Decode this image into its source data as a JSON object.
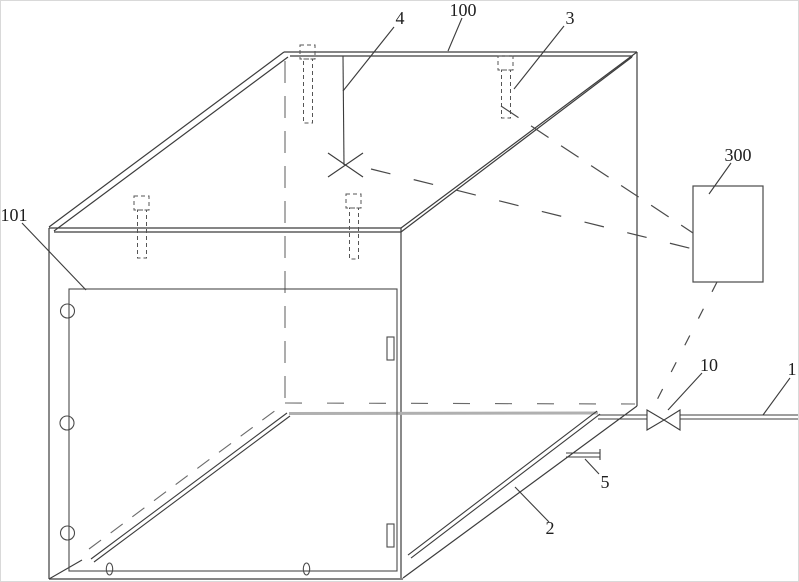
{
  "figure": {
    "kind": "patent-technical-line-drawing",
    "colors": {
      "line": "#3c3c3c",
      "hidden_dash": "#6a6a6a",
      "signal_dash": "#4a4a4a",
      "floor_back_edge": "#b0b0b0",
      "background": "#ffffff"
    }
  },
  "ref_labels": {
    "l100": "100",
    "l101": "101",
    "l3": "3",
    "l4": "4",
    "l300": "300",
    "l10": "10",
    "l1": "1",
    "l5": "5",
    "l2": "2"
  }
}
